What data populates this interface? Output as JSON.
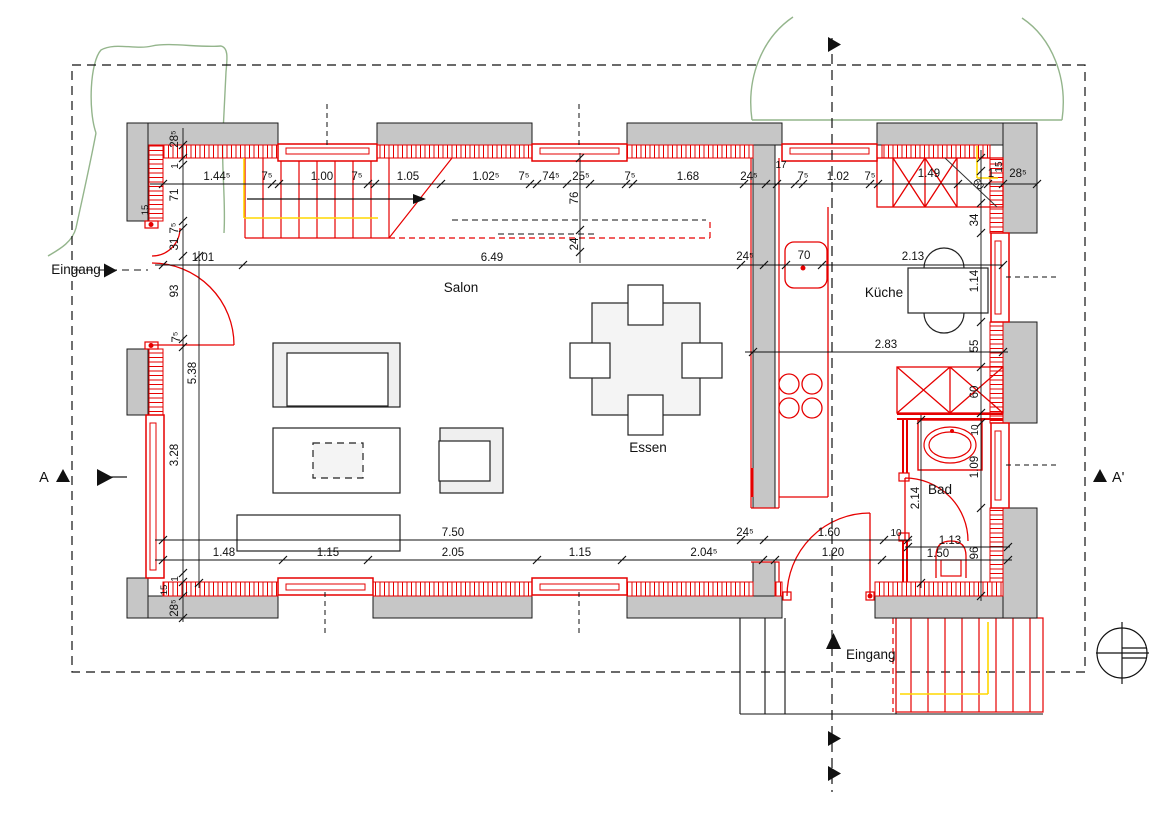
{
  "drawing": {
    "type": "architectural-floor-plan",
    "colors": {
      "wall_gray": "#c6c6c6",
      "line_red": "#e60000",
      "rail_yellow": "#ffd700",
      "landscape_green": "#94b58c",
      "line_black": "#111111"
    },
    "rooms": [
      {
        "label": "Salon",
        "x": 461,
        "y": 292
      },
      {
        "label": "Küche",
        "x": 884,
        "y": 297
      },
      {
        "label": "Essen",
        "x": 648,
        "y": 452
      },
      {
        "label": "Bad",
        "x": 940,
        "y": 494
      }
    ],
    "entrances": [
      {
        "label": "Eingang",
        "x": 76,
        "y": 274
      },
      {
        "label": "Eingang",
        "x": 846,
        "y": 659,
        "a": "start"
      }
    ],
    "section_markers": [
      {
        "label": "A",
        "x": 44,
        "y": 482
      },
      {
        "label": "A'",
        "x": 1112,
        "y": 482,
        "a": "start"
      }
    ],
    "dimensions": [
      {
        "t": "1.44⁵",
        "x": 217,
        "y": 180
      },
      {
        "t": "7⁵",
        "x": 267,
        "y": 180
      },
      {
        "t": "1.00",
        "x": 322,
        "y": 180
      },
      {
        "t": "7⁵",
        "x": 357,
        "y": 180
      },
      {
        "t": "1.05",
        "x": 408,
        "y": 180
      },
      {
        "t": "1.02⁵",
        "x": 486,
        "y": 180
      },
      {
        "t": "7⁵",
        "x": 524,
        "y": 180
      },
      {
        "t": "74⁵",
        "x": 551,
        "y": 180
      },
      {
        "t": "25⁵",
        "x": 581,
        "y": 180
      },
      {
        "t": "7⁵",
        "x": 630,
        "y": 180
      },
      {
        "t": "1.68",
        "x": 688,
        "y": 180
      },
      {
        "t": "24⁵",
        "x": 749,
        "y": 180
      },
      {
        "t": "17",
        "x": 781,
        "y": 168,
        "s": 10
      },
      {
        "t": "7⁵",
        "x": 803,
        "y": 180
      },
      {
        "t": "1.02",
        "x": 838,
        "y": 180
      },
      {
        "t": "7⁵",
        "x": 870,
        "y": 180
      },
      {
        "t": "1.49",
        "x": 929,
        "y": 177
      },
      {
        "t": "1",
        "x": 991,
        "y": 177
      },
      {
        "t": "28⁵",
        "x": 1018,
        "y": 177
      },
      {
        "t": "15",
        "x": 1002,
        "y": 167,
        "r": -90,
        "s": 10
      },
      {
        "t": "60",
        "x": 976,
        "y": 186,
        "r": 52,
        "s": 10
      },
      {
        "t": "1.01",
        "x": 203,
        "y": 261
      },
      {
        "t": "6.49",
        "x": 492,
        "y": 261
      },
      {
        "t": "24⁵",
        "x": 745,
        "y": 260
      },
      {
        "t": "70",
        "x": 804,
        "y": 259
      },
      {
        "t": "2.13",
        "x": 913,
        "y": 260
      },
      {
        "t": "2.83",
        "x": 886,
        "y": 348
      },
      {
        "t": "34",
        "x": 978,
        "y": 220,
        "r": -90
      },
      {
        "t": "1.14",
        "x": 978,
        "y": 281,
        "r": -90
      },
      {
        "t": "55",
        "x": 978,
        "y": 346,
        "r": -90
      },
      {
        "t": "60",
        "x": 978,
        "y": 392,
        "r": -90
      },
      {
        "t": "10",
        "x": 978,
        "y": 430,
        "r": -90,
        "s": 10
      },
      {
        "t": "1.09",
        "x": 978,
        "y": 467,
        "r": -90
      },
      {
        "t": "96",
        "x": 978,
        "y": 553,
        "r": -90
      },
      {
        "t": "2.14",
        "x": 919,
        "y": 498,
        "r": -90
      },
      {
        "t": "28⁵",
        "x": 178,
        "y": 139,
        "r": -90
      },
      {
        "t": "1",
        "x": 178,
        "y": 166,
        "r": -90,
        "s": 10
      },
      {
        "t": "71",
        "x": 178,
        "y": 195,
        "r": -90
      },
      {
        "t": "7⁵",
        "x": 178,
        "y": 228,
        "r": -90
      },
      {
        "t": "31",
        "x": 178,
        "y": 244,
        "r": -90
      },
      {
        "t": "93",
        "x": 178,
        "y": 291,
        "r": -90
      },
      {
        "t": "7⁵",
        "x": 180,
        "y": 337,
        "r": -90
      },
      {
        "t": "5.38",
        "x": 196,
        "y": 373,
        "r": -90
      },
      {
        "t": "3.28",
        "x": 178,
        "y": 455,
        "r": -90
      },
      {
        "t": "15",
        "x": 148,
        "y": 210,
        "r": -90,
        "s": 9.5
      },
      {
        "t": "1",
        "x": 178,
        "y": 579,
        "r": -90,
        "s": 10
      },
      {
        "t": "15",
        "x": 167,
        "y": 590,
        "r": -90,
        "s": 9.5
      },
      {
        "t": "28⁵",
        "x": 178,
        "y": 608,
        "r": -90
      },
      {
        "t": "76",
        "x": 578,
        "y": 198,
        "r": -90
      },
      {
        "t": "24",
        "x": 578,
        "y": 244,
        "r": -90
      },
      {
        "t": "7.50",
        "x": 453,
        "y": 536
      },
      {
        "t": "24⁵",
        "x": 745,
        "y": 536
      },
      {
        "t": "1.60",
        "x": 829,
        "y": 536
      },
      {
        "t": "10",
        "x": 896,
        "y": 536,
        "s": 10
      },
      {
        "t": "1.13",
        "x": 950,
        "y": 544
      },
      {
        "t": "1.48",
        "x": 224,
        "y": 556
      },
      {
        "t": "1.15",
        "x": 328,
        "y": 556
      },
      {
        "t": "2.05",
        "x": 453,
        "y": 556
      },
      {
        "t": "1.15",
        "x": 580,
        "y": 556
      },
      {
        "t": "2.04⁵",
        "x": 704,
        "y": 556
      },
      {
        "t": "1.20",
        "x": 833,
        "y": 556
      },
      {
        "t": "1.50",
        "x": 938,
        "y": 557
      }
    ]
  }
}
